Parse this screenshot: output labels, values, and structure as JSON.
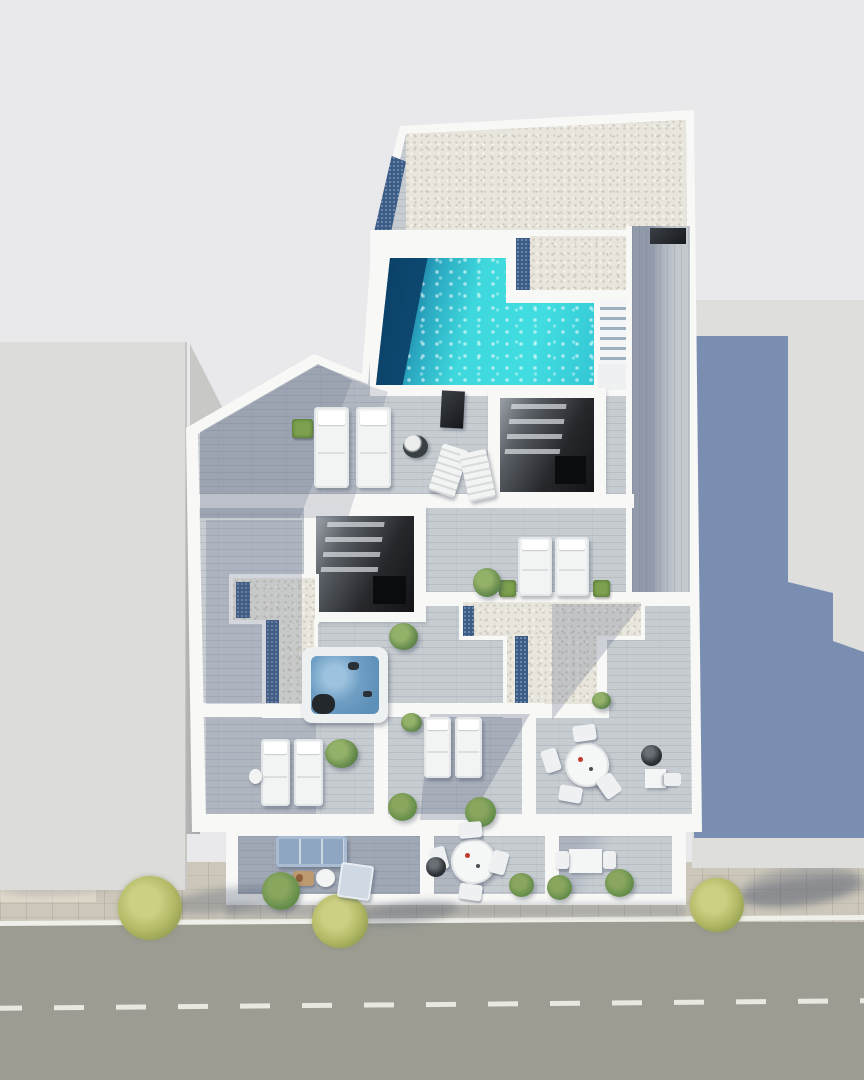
{
  "meta": {
    "kind": "architectural-3d-render",
    "view": "top-down aerial",
    "subject": "rooftop and terrace floor plan of an apartment building beside a street"
  },
  "colors": {
    "bg": "#e9e9ec",
    "wall": "#f8f8f6",
    "neighbor": "#dcdcda",
    "castShadow": "#7187ac",
    "gravel": "#e8e5dd",
    "deck": "#c7ccd1",
    "strip": "#3c5c88",
    "poolBright": "#3ed8dd",
    "poolDark": "#0d4a74",
    "jacuzzi": "#6f9ec4",
    "sofa": "#8ea6c2",
    "road": "#9c9c93",
    "roadLine": "#f0f0ea",
    "sidewalk": "#ccc7ba"
  },
  "scene": {
    "regions": [
      "gravel-flat-roof",
      "swimming-pool",
      "pool-steps",
      "roof-deck-walkway",
      "stairwell-skylight-upper",
      "stairwell-skylight-lower",
      "sun-deck",
      "jacuzzi-terrace",
      "gravel-roof-L-section",
      "gravel-roof-T-section",
      "lounger-room-left",
      "lounger-room-middle",
      "dining-terrace",
      "ground-terrace-left",
      "ground-terrace-middle",
      "ground-terrace-right",
      "neighbor-building-left",
      "neighbor-building-right",
      "sidewalk",
      "street"
    ],
    "objects": [
      {
        "type": "tree-shadow",
        "name": "tree-shadow",
        "x": 168,
        "y": 888,
        "w": 120,
        "h": 24,
        "rot": -7
      },
      {
        "type": "tree-shadow",
        "name": "tree-shadow",
        "x": 358,
        "y": 902,
        "w": 100,
        "h": 22,
        "rot": -7
      },
      {
        "type": "tree-shadow",
        "name": "tree-shadow",
        "x": 738,
        "y": 878,
        "w": 130,
        "h": 26,
        "rot": -7
      },
      {
        "type": "tree",
        "name": "street-tree",
        "x": 118,
        "y": 876,
        "w": 64,
        "h": 64
      },
      {
        "type": "tree",
        "name": "street-tree",
        "x": 312,
        "y": 894,
        "w": 56,
        "h": 54
      },
      {
        "type": "tree",
        "name": "street-tree",
        "x": 690,
        "y": 878,
        "w": 54,
        "h": 54
      },
      {
        "type": "plant-box",
        "name": "planter",
        "x": 292,
        "y": 419,
        "w": 21,
        "h": 19
      },
      {
        "type": "lounger",
        "name": "sun-lounger",
        "x": 314,
        "y": 407,
        "w": 35,
        "h": 81
      },
      {
        "type": "lounger",
        "name": "sun-lounger",
        "x": 356,
        "y": 407,
        "w": 35,
        "h": 81
      },
      {
        "type": "dark-panel",
        "name": "outdoor-shower-panel",
        "x": 441,
        "y": 391,
        "w": 23,
        "h": 37,
        "rot": 3
      },
      {
        "type": "ottoman",
        "name": "ottoman",
        "x": 403,
        "y": 435,
        "w": 25,
        "h": 23
      },
      {
        "type": "folding-chair",
        "name": "deck-chair",
        "x": 435,
        "y": 446,
        "w": 27,
        "h": 49,
        "rot": 18
      },
      {
        "type": "folding-chair",
        "name": "deck-chair",
        "x": 464,
        "y": 451,
        "w": 27,
        "h": 49,
        "rot": -12
      },
      {
        "type": "plant-box",
        "name": "planter",
        "x": 499,
        "y": 580,
        "w": 17,
        "h": 17
      },
      {
        "type": "lounger",
        "name": "sun-lounger",
        "x": 518,
        "y": 537,
        "w": 34,
        "h": 59
      },
      {
        "type": "lounger",
        "name": "sun-lounger",
        "x": 555,
        "y": 537,
        "w": 34,
        "h": 59
      },
      {
        "type": "plant-box",
        "name": "planter",
        "x": 593,
        "y": 580,
        "w": 17,
        "h": 17
      },
      {
        "type": "plant",
        "name": "potted-plant",
        "x": 473,
        "y": 568,
        "w": 28,
        "h": 29
      },
      {
        "type": "plant",
        "name": "potted-plant",
        "x": 389,
        "y": 623,
        "w": 29,
        "h": 27
      },
      {
        "type": "jacuzzi",
        "name": "jacuzzi",
        "x": 302,
        "y": 647,
        "w": 86,
        "h": 76
      },
      {
        "type": "lounger-sm",
        "name": "sun-lounger",
        "x": 261,
        "y": 739,
        "w": 29,
        "h": 67
      },
      {
        "type": "lounger-sm",
        "name": "sun-lounger",
        "x": 294,
        "y": 739,
        "w": 29,
        "h": 67
      },
      {
        "type": "side-table",
        "name": "side-table",
        "x": 249,
        "y": 769,
        "w": 13,
        "h": 15
      },
      {
        "type": "plant",
        "name": "potted-plant",
        "x": 325,
        "y": 739,
        "w": 33,
        "h": 29
      },
      {
        "type": "shrub",
        "name": "shrub",
        "x": 388,
        "y": 793,
        "w": 29,
        "h": 28
      },
      {
        "type": "plant",
        "name": "potted-plant",
        "x": 401,
        "y": 713,
        "w": 21,
        "h": 19
      },
      {
        "type": "lounger-sm",
        "name": "sun-lounger",
        "x": 424,
        "y": 717,
        "w": 27,
        "h": 61
      },
      {
        "type": "lounger-sm",
        "name": "sun-lounger",
        "x": 455,
        "y": 717,
        "w": 27,
        "h": 61
      },
      {
        "type": "shrub",
        "name": "shrub",
        "x": 465,
        "y": 797,
        "w": 31,
        "h": 30
      },
      {
        "type": "plant",
        "name": "gravel-plant",
        "x": 592,
        "y": 692,
        "w": 19,
        "h": 17
      },
      {
        "type": "round-table",
        "name": "dining-table",
        "x": 565,
        "y": 743,
        "w": 44,
        "h": 44
      },
      {
        "type": "chair",
        "name": "dining-chair",
        "x": 573,
        "y": 725,
        "w": 23,
        "h": 16,
        "rot": -8
      },
      {
        "type": "chair",
        "name": "dining-chair",
        "x": 543,
        "y": 749,
        "w": 16,
        "h": 23,
        "rot": -18
      },
      {
        "type": "chair",
        "name": "dining-chair",
        "x": 559,
        "y": 786,
        "w": 23,
        "h": 16,
        "rot": 10
      },
      {
        "type": "chair",
        "name": "dining-chair",
        "x": 598,
        "y": 777,
        "w": 22,
        "h": 18,
        "rot": 55
      },
      {
        "type": "pot-dark",
        "name": "planter-pot",
        "x": 641,
        "y": 745,
        "w": 21,
        "h": 21
      },
      {
        "type": "small-table",
        "name": "bistro-table",
        "x": 645,
        "y": 769,
        "w": 21,
        "h": 19
      },
      {
        "type": "chair",
        "name": "bistro-chair",
        "x": 666,
        "y": 771,
        "w": 13,
        "h": 17,
        "rot": 90
      },
      {
        "type": "sofa",
        "name": "outdoor-sofa",
        "x": 276,
        "y": 836,
        "w": 71,
        "h": 31
      },
      {
        "type": "tray-table",
        "name": "coffee-table",
        "x": 293,
        "y": 871,
        "w": 21,
        "h": 15
      },
      {
        "type": "side-table",
        "name": "side-table",
        "x": 316,
        "y": 869,
        "w": 19,
        "h": 18
      },
      {
        "type": "daybed",
        "name": "lounge-chair",
        "x": 339,
        "y": 864,
        "w": 33,
        "h": 35,
        "rot": 8
      },
      {
        "type": "shrub",
        "name": "terrace-tree",
        "x": 262,
        "y": 872,
        "w": 38,
        "h": 38
      },
      {
        "type": "round-table",
        "name": "dining-table",
        "x": 451,
        "y": 839,
        "w": 45,
        "h": 45
      },
      {
        "type": "chair",
        "name": "dining-chair",
        "x": 459,
        "y": 822,
        "w": 23,
        "h": 16,
        "rot": -5
      },
      {
        "type": "chair",
        "name": "dining-chair",
        "x": 431,
        "y": 847,
        "w": 16,
        "h": 23,
        "rot": -15
      },
      {
        "type": "chair",
        "name": "dining-chair",
        "x": 459,
        "y": 884,
        "w": 23,
        "h": 16,
        "rot": 8
      },
      {
        "type": "chair",
        "name": "dining-chair",
        "x": 491,
        "y": 851,
        "w": 16,
        "h": 23,
        "rot": 15
      },
      {
        "type": "pot-dark",
        "name": "planter-pot",
        "x": 426,
        "y": 857,
        "w": 20,
        "h": 20
      },
      {
        "type": "shrub",
        "name": "shrub",
        "x": 509,
        "y": 873,
        "w": 25,
        "h": 24
      },
      {
        "type": "small-table",
        "name": "bistro-table",
        "x": 569,
        "y": 849,
        "w": 33,
        "h": 24
      },
      {
        "type": "chair",
        "name": "bistro-chair",
        "x": 556,
        "y": 851,
        "w": 13,
        "h": 18
      },
      {
        "type": "chair",
        "name": "bistro-chair",
        "x": 603,
        "y": 851,
        "w": 13,
        "h": 18
      },
      {
        "type": "shrub",
        "name": "shrub",
        "x": 547,
        "y": 875,
        "w": 25,
        "h": 25
      },
      {
        "type": "shrub",
        "name": "shrub",
        "x": 605,
        "y": 869,
        "w": 29,
        "h": 28
      }
    ]
  }
}
